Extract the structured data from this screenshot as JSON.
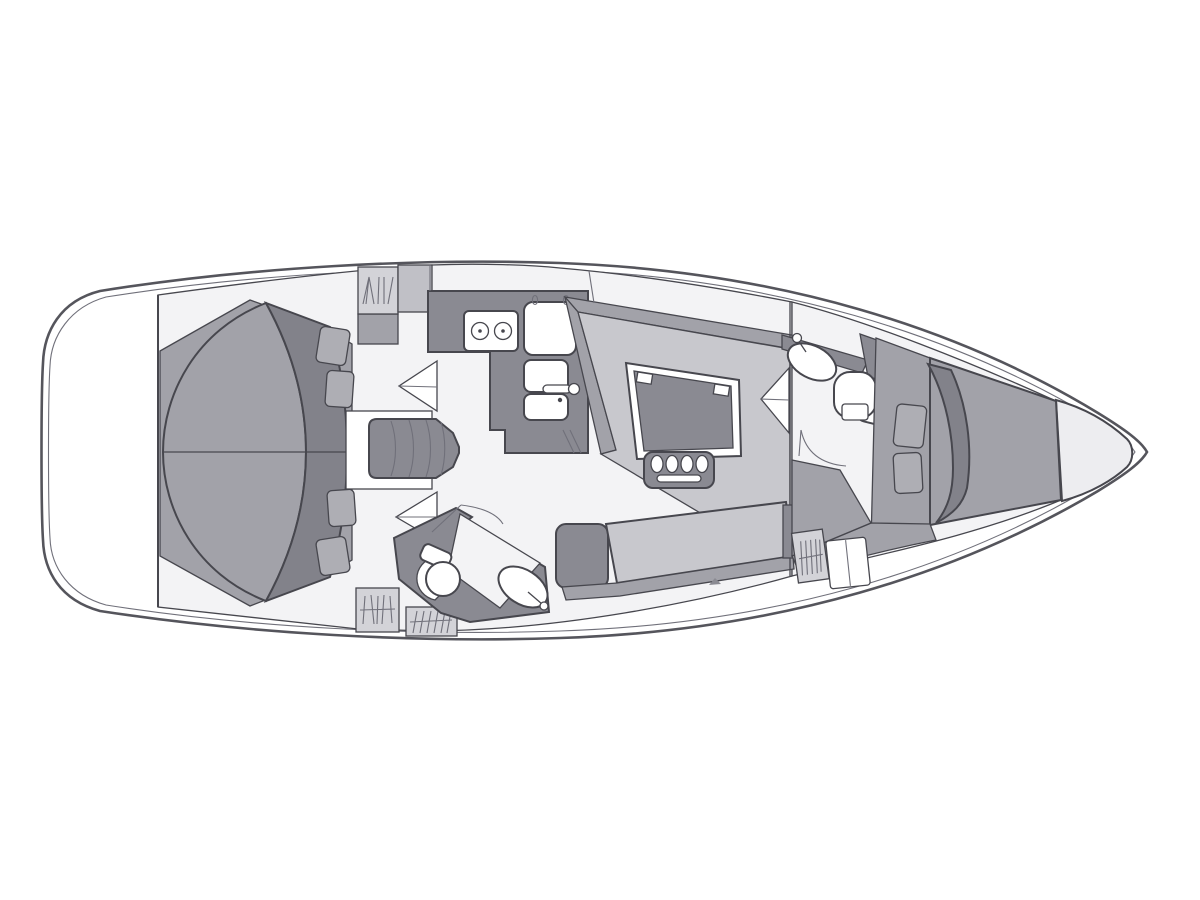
{
  "meta": {
    "title": "Sailing yacht interior layout floor plan",
    "type": "boat-floorplan",
    "orientation": "bow-right",
    "canvas": {
      "width": 1200,
      "height": 900
    }
  },
  "colors": {
    "background": "#ffffff",
    "deck": "#e8e8ea",
    "forepeak": "#ededf0",
    "floor": "#f3f3f5",
    "white": "#ffffff",
    "cushion": "#c8c8cd",
    "gray_mid": "#a2a2a9",
    "pillow": "#aeaeb4",
    "gray_dark": "#8a8a92",
    "blanket": "#82828a",
    "locker": "#d3d3d8",
    "locker_plain": "#c0c0c6",
    "outline": "#47474e"
  },
  "items": {
    "hull": "hull-outline",
    "stern": "stern-deck",
    "aft_cabin": "aft-double-berth-cabin",
    "aft_bed": "aft-double-berth",
    "pillows": "pillows",
    "steps": "companionway-steps",
    "galley": "galley-counter",
    "stove": "two-burner-stove",
    "fridge": "top-loading-fridge",
    "sinks": "double-sink",
    "salon": "salon",
    "table": "salon-table",
    "bench": "salon-bench-seat",
    "settee": "settee-sofa",
    "nav_seat": "corner-seat",
    "aft_head": "aft-head-bathroom",
    "fwd_head": "forward-head-bathroom",
    "toilet": "toilet",
    "washbasin": "washbasin",
    "v_berth": "v-berth-cabin",
    "bow_locker": "bow-anchor-locker",
    "hatched": "storage-locker-hatched",
    "doors": "door-swing"
  }
}
